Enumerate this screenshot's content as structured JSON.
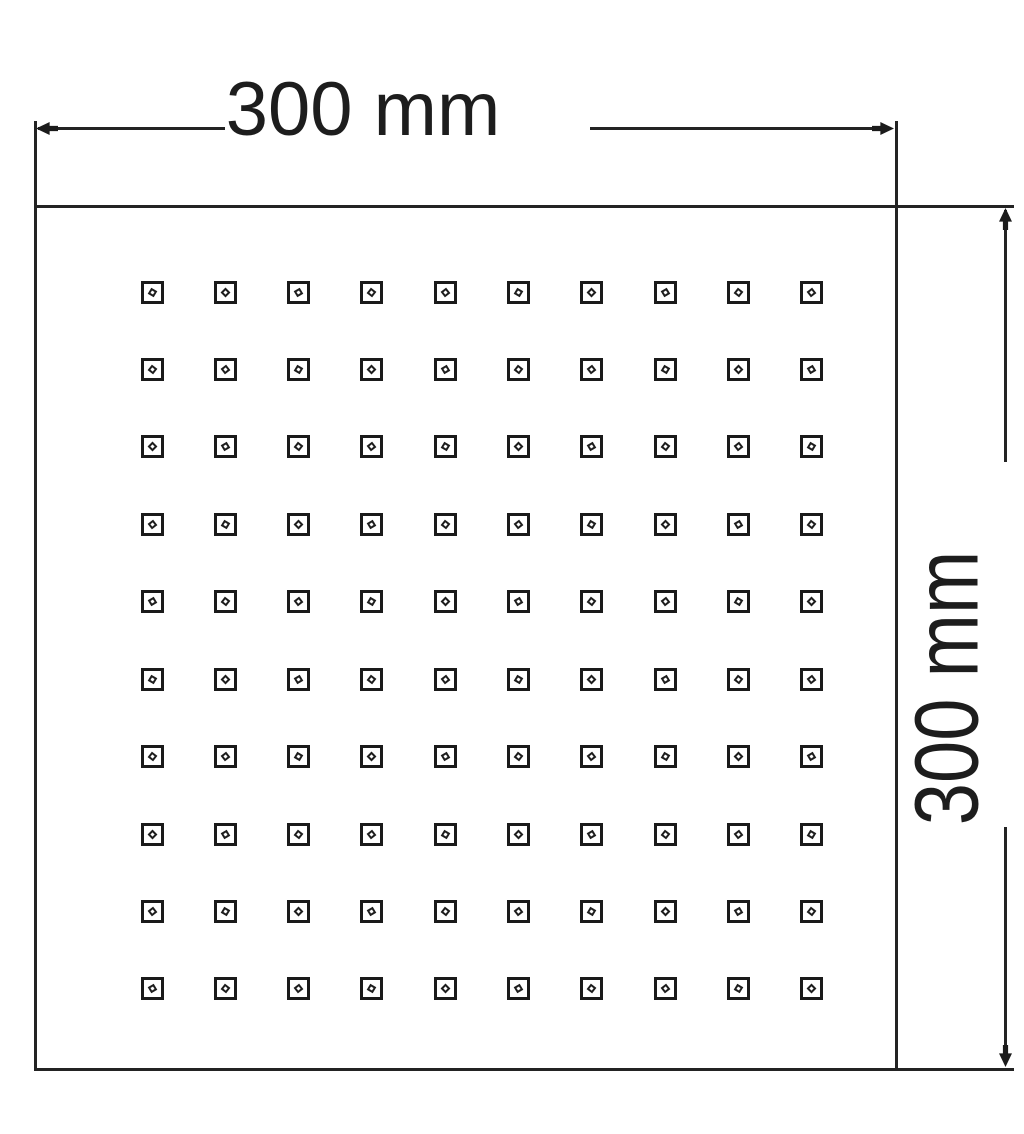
{
  "drawing": {
    "type": "technical-drawing",
    "dimension_top": {
      "label": "300 mm"
    },
    "dimension_right": {
      "label": "300 mm"
    },
    "plate": {
      "shape": "square",
      "nozzle_rows": 10,
      "nozzle_columns": 10,
      "nozzle_total": 100
    },
    "colors": {
      "line": "#232323",
      "text": "#1d1d1d",
      "background": "#ffffff"
    }
  }
}
